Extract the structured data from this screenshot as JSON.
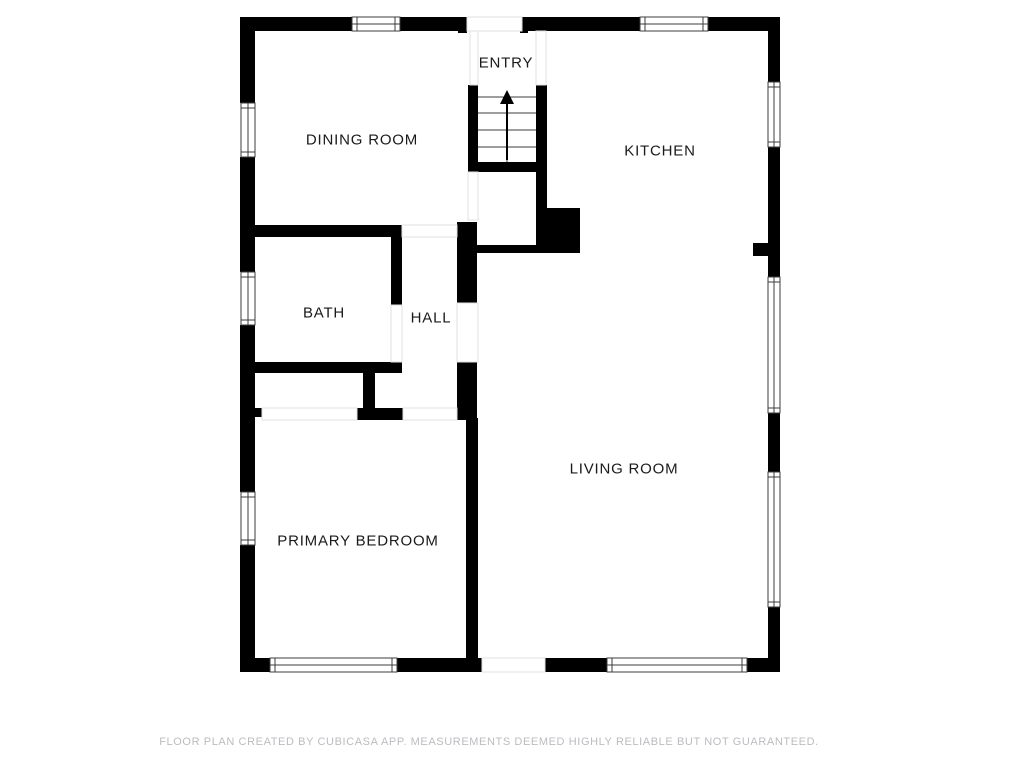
{
  "plan": {
    "rooms": {
      "entry": {
        "label": "ENTRY"
      },
      "dining": {
        "label": "DINING ROOM"
      },
      "kitchen": {
        "label": "KITCHEN"
      },
      "bath": {
        "label": "BATH"
      },
      "hall": {
        "label": "HALL"
      },
      "living": {
        "label": "LIVING ROOM"
      },
      "bedroom": {
        "label": "PRIMARY BEDROOM"
      }
    },
    "stairs": {
      "direction_icon": "up-arrow",
      "treads": 4
    }
  },
  "footer": {
    "disclaimer": "FLOOR PLAN CREATED BY CUBICASA APP. MEASUREMENTS DEEMED HIGHLY RELIABLE BUT NOT GUARANTEED."
  },
  "colors": {
    "wall": "#000000",
    "background": "#ffffff",
    "label_text": "#1a1a1a",
    "footer_text": "#bcbcc0",
    "stair_line": "#3d3d3d"
  }
}
